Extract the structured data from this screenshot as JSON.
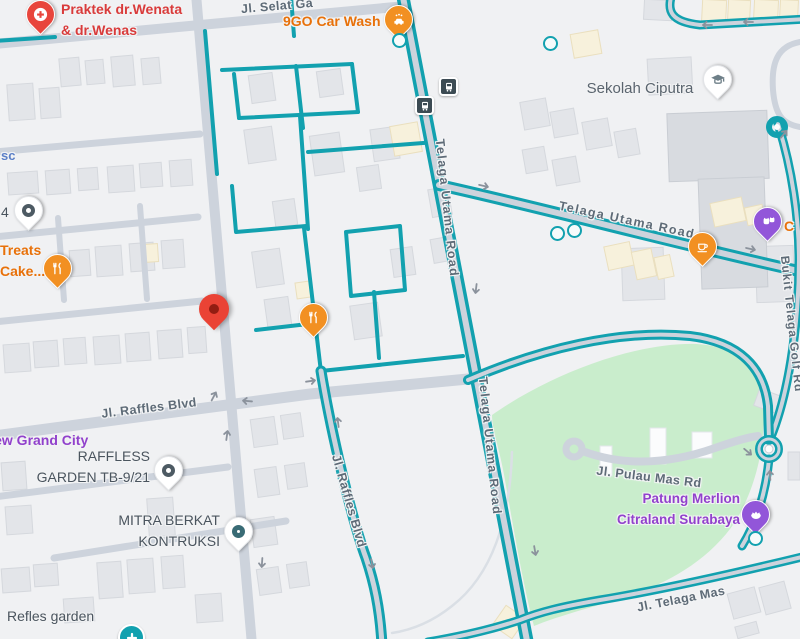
{
  "app": "map-view",
  "colors": {
    "background": "#f0f1f3",
    "road_gray": "#cdd3dc",
    "bike_teal": "#12a1af",
    "park_green": "#c9edcc",
    "street_label": "#5e6b77",
    "poi_gray_label": "#4a545e",
    "poi_orange": "#e8710a",
    "poi_red": "#d93b3b",
    "poi_purple": "#9141cc",
    "poi_blue": "#5b7fc7",
    "marker_red": "#ea4335",
    "bus_stop": "#3c4b53"
  },
  "streets": {
    "selat": "Jl. Selat Ga",
    "telaga_utama": "Telaga Utama Road",
    "raffles": "Jl. Raffles Blvd",
    "pulau_mas": "Jl. Pulau Mas Rd",
    "telaga_mas": "Jl. Telaga Mas",
    "bukit": "Bukit Telaga Golf Rd"
  },
  "pois": {
    "praktek": {
      "line1": "Praktek dr.Wenata",
      "line2": "& dr.Wenas"
    },
    "carwash": {
      "label": "9GO Car Wash"
    },
    "sekolah": {
      "label": "Sekolah Ciputra"
    },
    "sc": {
      "label": "sc"
    },
    "four": {
      "label": "4"
    },
    "treats": {
      "line1": "Treats",
      "line2": "Cake..."
    },
    "grand_city": {
      "label": "New Grand City"
    },
    "raffless": {
      "line1": "RAFFLESS",
      "line2": "GARDEN TB-9/21"
    },
    "mitra": {
      "line1": "MITRA BERKAT",
      "line2": "KONTRUKSI"
    },
    "merlion": {
      "line1": "Patung Merlion",
      "line2": "Citraland Surabaya"
    },
    "refles": {
      "label": "Refles garden"
    },
    "c_partial": {
      "label": "C"
    }
  },
  "icons": {
    "hospital-pin-icon": "red pin, white circle with red cross",
    "car-wash-pin-icon": "orange pin, white car",
    "restaurant-pin-icon": "orange pin, white fork and knife",
    "coffee-pin-icon": "orange pin, white coffee cup",
    "school-pin-icon": "white pin, graduation cap",
    "pet-store-pin-icon": "purple pin, two animal faces",
    "attraction-pin-icon": "purple pin, merlion crown",
    "generic-pin-icon": "white pin, dark ring",
    "destination-marker-icon": "large red teardrop marker",
    "bus-stop-icon": "dark square, white bus",
    "medical-plus-icon": "teal circle, white plus",
    "poi-dot-icon": "small teal ring"
  }
}
